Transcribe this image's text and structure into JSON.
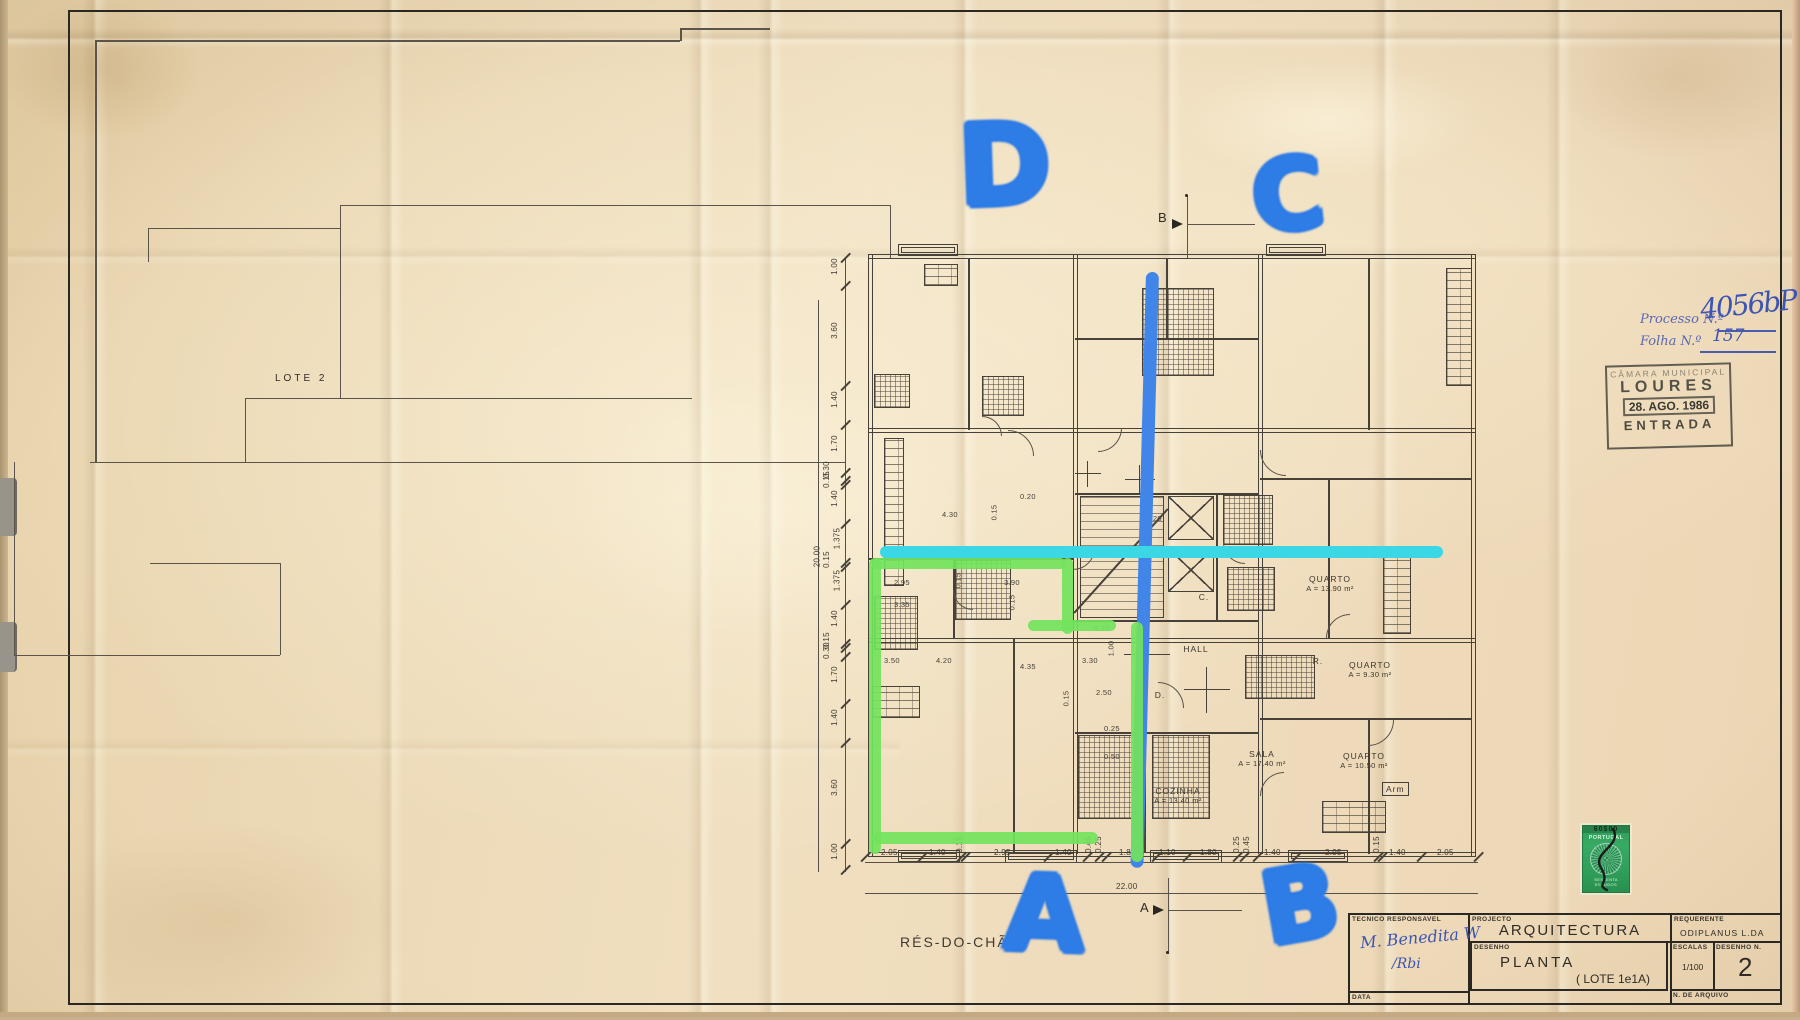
{
  "page": {
    "sheet_label_bottom": "RÉS-DO-CHÃO",
    "lot_label": "LOTE  2",
    "paper_color": "#edd9b6",
    "ink_color": "#474239"
  },
  "annotations": {
    "marker_blue": "#2e7ce6",
    "marker_cyan": "#3bd7e4",
    "marker_green": "#72e35c",
    "letters": [
      {
        "char": "D",
        "x": 958,
        "y": 116,
        "size": 112,
        "rot": -2
      },
      {
        "char": "C",
        "x": 1252,
        "y": 152,
        "size": 98,
        "rot": -6
      },
      {
        "char": "A",
        "x": 1004,
        "y": 868,
        "size": 104,
        "rot": 2
      },
      {
        "char": "B",
        "x": 1262,
        "y": 860,
        "size": 100,
        "rot": -10
      }
    ],
    "processo": {
      "label": "Processo N.º",
      "value": "4056bP",
      "folha_label": "Folha N.º",
      "folha_value": "157",
      "ink": "#4a5cb0"
    },
    "signature_line1": "M. Benedita W",
    "signature_line2": "/Rbi"
  },
  "stamps": {
    "entrada": {
      "line1": "CÂMARA MUNICIPAL",
      "line2": "LOURES",
      "date": "28. AGO. 1986",
      "line3": "ENTRADA"
    },
    "tax": {
      "value": "60$00",
      "country": "PORTUGAL",
      "bottom": "SESSENTA ESCUDOS",
      "color": "#2f9e5a"
    }
  },
  "title_block": {
    "tecnico_label": "TECNICO RESPONSAVEL",
    "projecto_label": "PROJECTO",
    "projecto": "ARQUITECTURA",
    "requerente_label": "REQUERENTE",
    "requerente": "ODIPLANUS  L.DA",
    "desenho_label": "DESENHO",
    "desenho": "PLANTA",
    "desenho_sub": "( LOTE  1e1A)",
    "escalas_label": "ESCALAS",
    "escalas": "1/100",
    "numero_label": "DESENHO N.",
    "numero": "2",
    "data_label": "DATA",
    "arquivo_label": "N. DE ARQUIVO"
  },
  "section_markers": {
    "top": "B",
    "bottom": "A"
  },
  "plan": {
    "rooms": [
      {
        "name": "QUARTO",
        "area": "A = 13.90 m²",
        "x": 472,
        "y": 322
      },
      {
        "name": "QUARTO",
        "area": "A = 9.30 m²",
        "x": 512,
        "y": 408
      },
      {
        "name": "SALA",
        "area": "A = 17.40 m²",
        "x": 404,
        "y": 497
      },
      {
        "name": "QUARTO",
        "area": "A = 10.50 m²",
        "x": 506,
        "y": 499
      },
      {
        "name": "COZINHA",
        "area": "A = 13.40 m²",
        "x": 320,
        "y": 534
      },
      {
        "name": "HALL",
        "x": 338,
        "y": 392
      },
      {
        "name": "Arm",
        "x": 524,
        "y": 530,
        "boxed": true
      },
      {
        "name": "C.",
        "x": 346,
        "y": 340
      },
      {
        "name": "D.",
        "x": 302,
        "y": 438
      },
      {
        "name": "R.",
        "x": 460,
        "y": 404
      }
    ],
    "interior_dims": [
      {
        "t": "4.30",
        "x": 84,
        "y": 258
      },
      {
        "t": "0.15",
        "x": 128,
        "y": 256,
        "r": 1
      },
      {
        "t": "0.20",
        "x": 162,
        "y": 240
      },
      {
        "t": "2.95",
        "x": 36,
        "y": 326
      },
      {
        "t": "0.15",
        "x": 92,
        "y": 324,
        "r": 1
      },
      {
        "t": "3.90",
        "x": 146,
        "y": 326
      },
      {
        "t": "3.35",
        "x": 36,
        "y": 348
      },
      {
        "t": "0.15",
        "x": 146,
        "y": 346,
        "r": 1
      },
      {
        "t": "3.50",
        "x": 26,
        "y": 404
      },
      {
        "t": "4.20",
        "x": 78,
        "y": 404
      },
      {
        "t": "4.35",
        "x": 162,
        "y": 410
      },
      {
        "t": "3.30",
        "x": 224,
        "y": 404
      },
      {
        "t": "1.00",
        "x": 245,
        "y": 392,
        "r": 1
      },
      {
        "t": "0.20",
        "x": 236,
        "y": 372
      },
      {
        "t": "2.50",
        "x": 238,
        "y": 436
      },
      {
        "t": "0.15",
        "x": 200,
        "y": 442,
        "r": 1
      },
      {
        "t": "0.25",
        "x": 246,
        "y": 472
      },
      {
        "t": "0.50",
        "x": 246,
        "y": 500
      },
      {
        "t": "0.20",
        "x": 288,
        "y": 262
      }
    ],
    "bottom_dims": {
      "total": "22.00",
      "ticks": [
        7,
        64,
        103,
        107,
        190,
        229,
        241,
        248,
        298,
        329,
        379,
        386,
        399,
        438,
        520,
        524,
        563,
        620
      ],
      "labels": [
        {
          "t": "2.05",
          "x": 33
        },
        {
          "t": "1.40",
          "x": 81
        },
        {
          "t": "0.15",
          "x": 103,
          "r": 1
        },
        {
          "t": "2.95",
          "x": 146
        },
        {
          "t": "1.40",
          "x": 207
        },
        {
          "t": "0.45",
          "x": 232,
          "r": 1
        },
        {
          "t": "0.25",
          "x": 242,
          "r": 1
        },
        {
          "t": "1.80",
          "x": 271
        },
        {
          "t": "1.10",
          "x": 311
        },
        {
          "t": "1.80",
          "x": 352
        },
        {
          "t": "0.25",
          "x": 380,
          "r": 1
        },
        {
          "t": "0.45",
          "x": 390,
          "r": 1
        },
        {
          "t": "1.40",
          "x": 416
        },
        {
          "t": "2.95",
          "x": 477
        },
        {
          "t": "0.15",
          "x": 520,
          "r": 1
        },
        {
          "t": "1.40",
          "x": 541
        },
        {
          "t": "2.05",
          "x": 589
        }
      ]
    },
    "left_dims": {
      "total": "20.00",
      "ticks": [
        6,
        34,
        134,
        173,
        221,
        229,
        233,
        272,
        311,
        315,
        353,
        392,
        396,
        405,
        452,
        491,
        592,
        618
      ],
      "labels": [
        {
          "t": "1.00",
          "y": 16
        },
        {
          "t": "3.60",
          "y": 80
        },
        {
          "t": "1.40",
          "y": 149
        },
        {
          "t": "1.70",
          "y": 193
        },
        {
          "t": "0.30",
          "y": 219,
          "x": -40
        },
        {
          "t": "0.15",
          "y": 229,
          "x": -40
        },
        {
          "t": "1.40",
          "y": 248
        },
        {
          "t": "1.375",
          "y": 288
        },
        {
          "t": "0.15",
          "y": 309,
          "x": -40
        },
        {
          "t": "1.375",
          "y": 330
        },
        {
          "t": "1.40",
          "y": 368
        },
        {
          "t": "0.15",
          "y": 390,
          "x": -40
        },
        {
          "t": "0.30",
          "y": 400,
          "x": -40
        },
        {
          "t": "1.70",
          "y": 424
        },
        {
          "t": "1.40",
          "y": 467
        },
        {
          "t": "3.60",
          "y": 537
        },
        {
          "t": "1.00",
          "y": 601
        }
      ]
    }
  }
}
